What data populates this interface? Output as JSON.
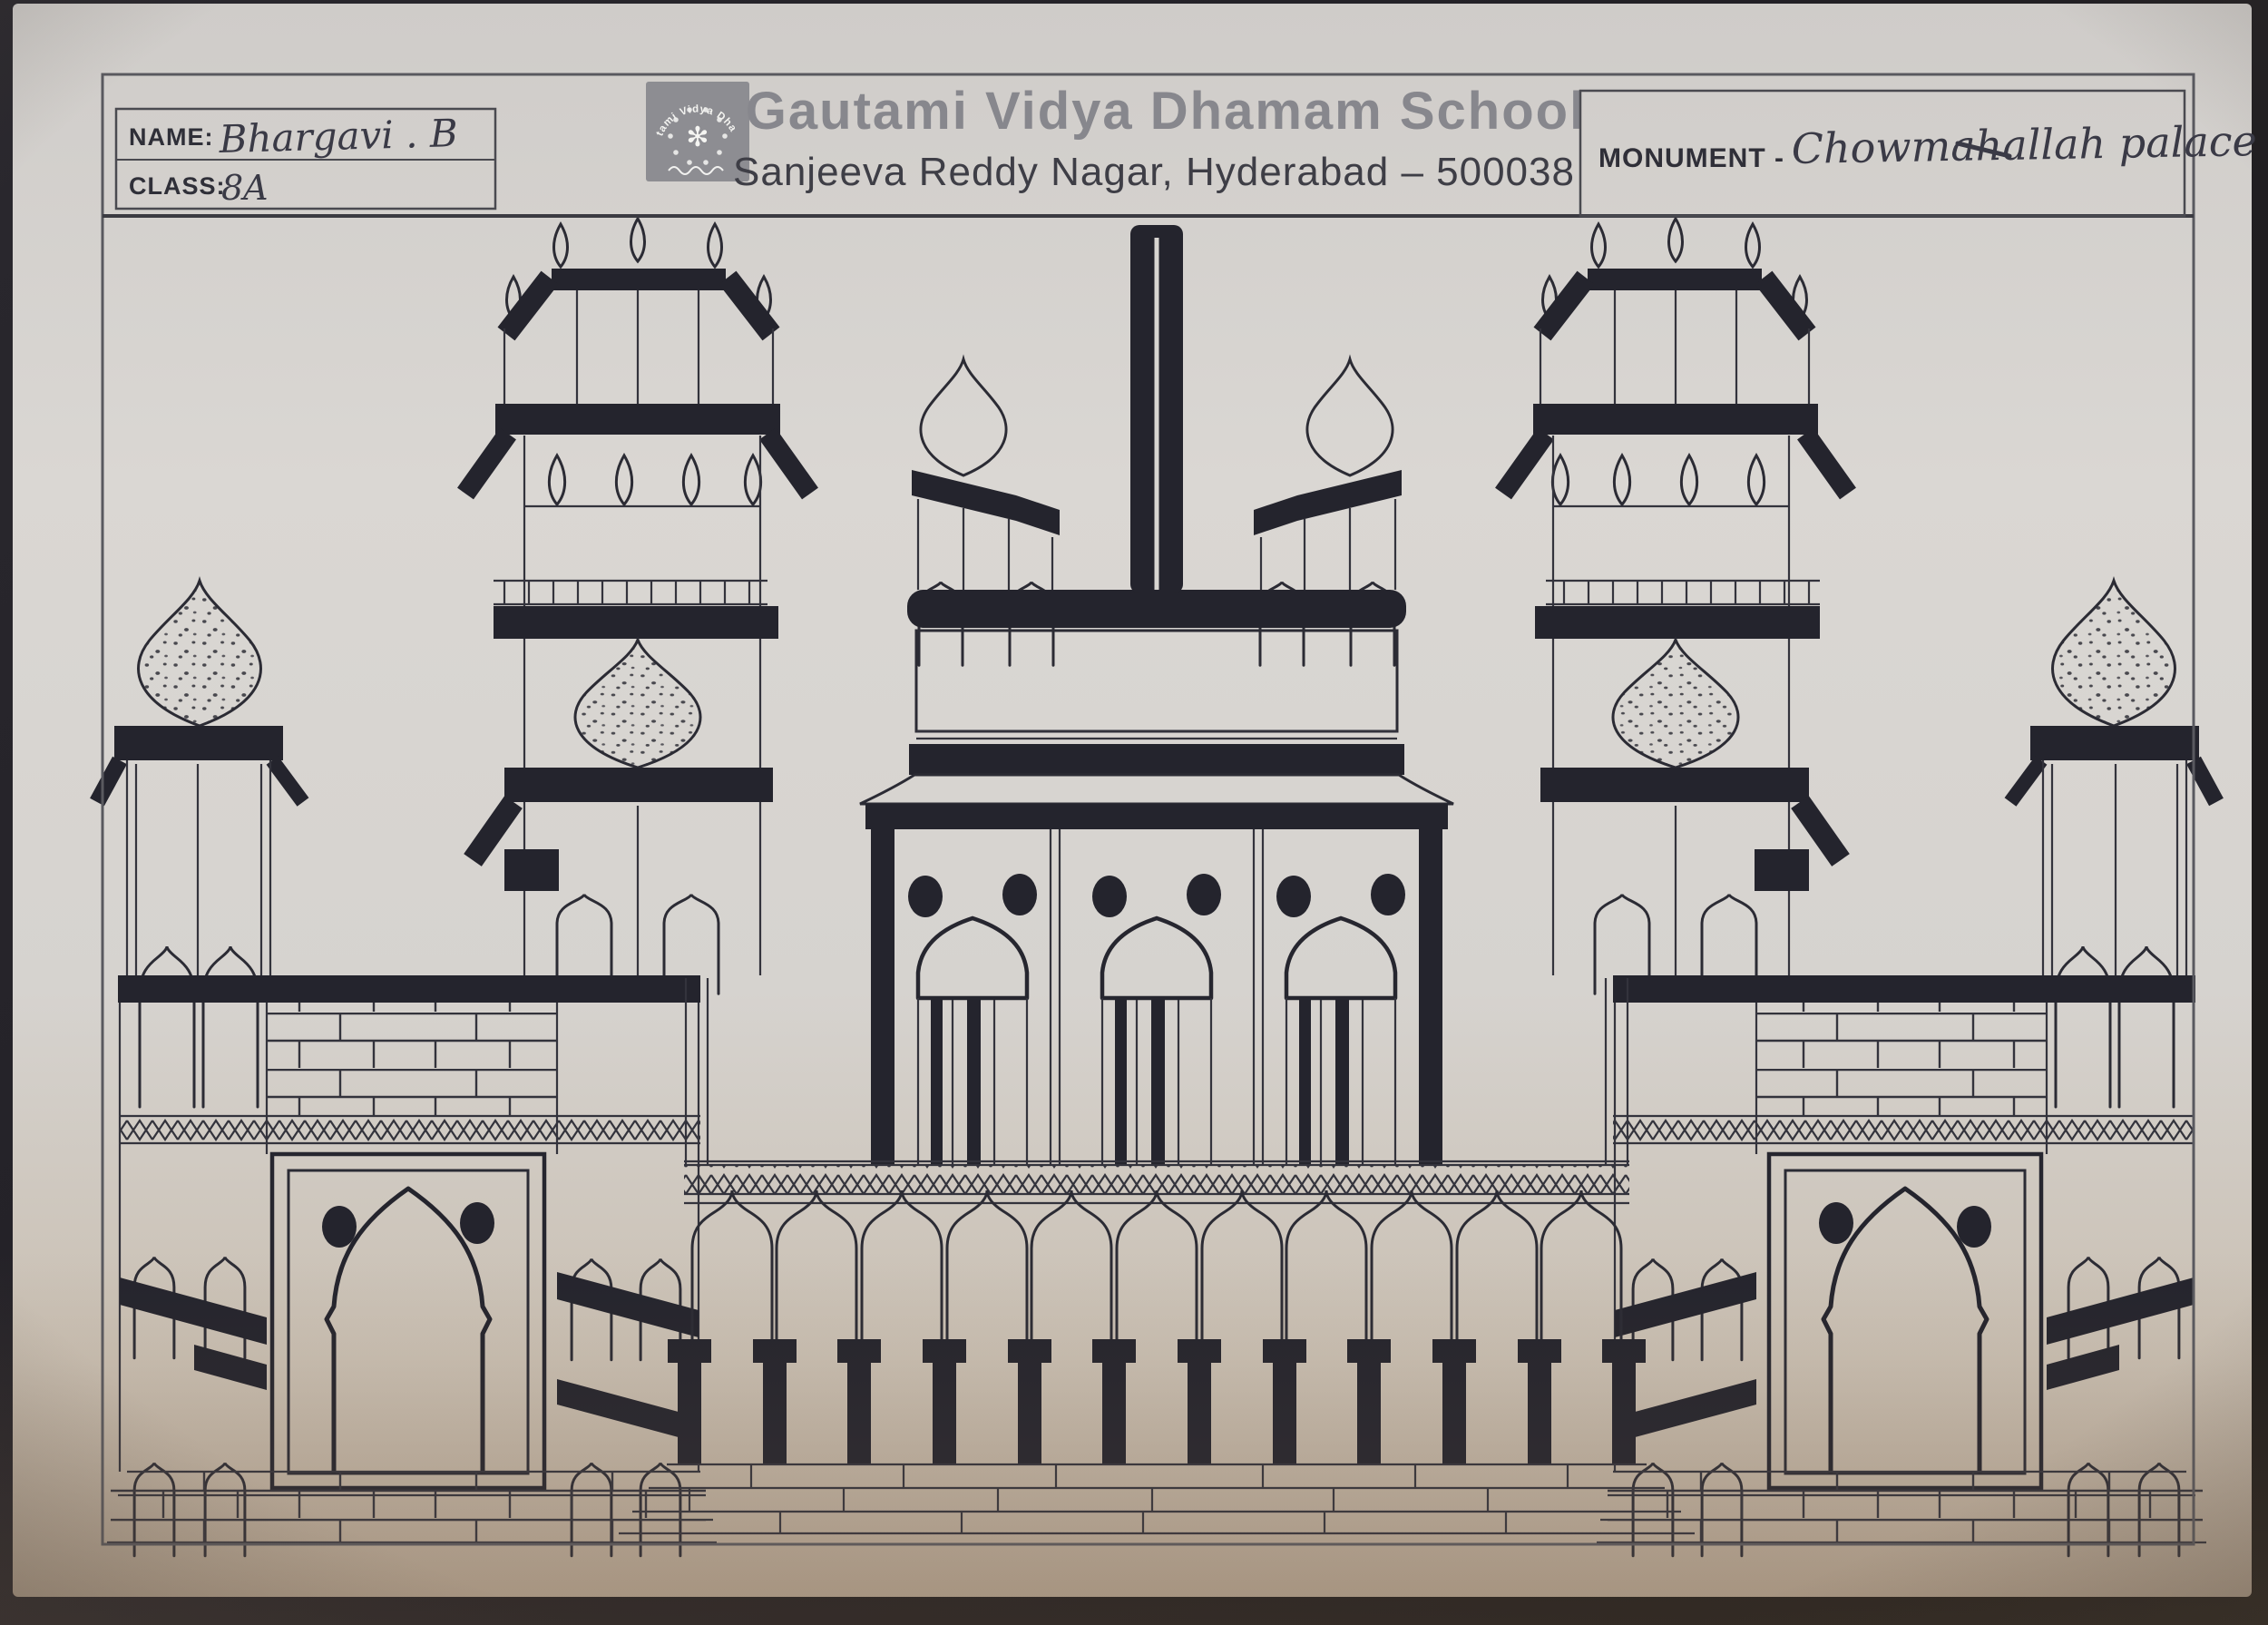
{
  "photo": {
    "paper_color": "#d7d4d0",
    "ink_color": "#24242d",
    "background_color": "#232127"
  },
  "header": {
    "name_label": "NAME:",
    "name_value": "Bhargavi . B",
    "class_label": "CLASS:",
    "class_value": "8A",
    "school_name": "Gautami Vidya Dhamam School",
    "school_address": "Sanjeeva Reddy Nagar, Hyderabad – 500038",
    "monument_label": "MONUMENT -",
    "monument_value": "Chowmahallah palace",
    "logo": {
      "arc_text": "Gautami Vidya Dhamam",
      "bottom_script": "Telugu script",
      "shape": "gray square emblem with white circular crest"
    }
  },
  "drawing": {
    "subject": "Chowmahallah palace",
    "style": "hand-drawn black ink elevation",
    "elements": [
      "central flag mast",
      "twin domed pavilions",
      "central arched facade with three barred windows",
      "ornamental cornice",
      "zigzag friezes",
      "eleven-arch colonnade with black columns",
      "left and right minaret towers with flame finials",
      "speckled onion domes",
      "arched gateway panels with twin dots",
      "brick walls",
      "stepped plinth"
    ]
  }
}
